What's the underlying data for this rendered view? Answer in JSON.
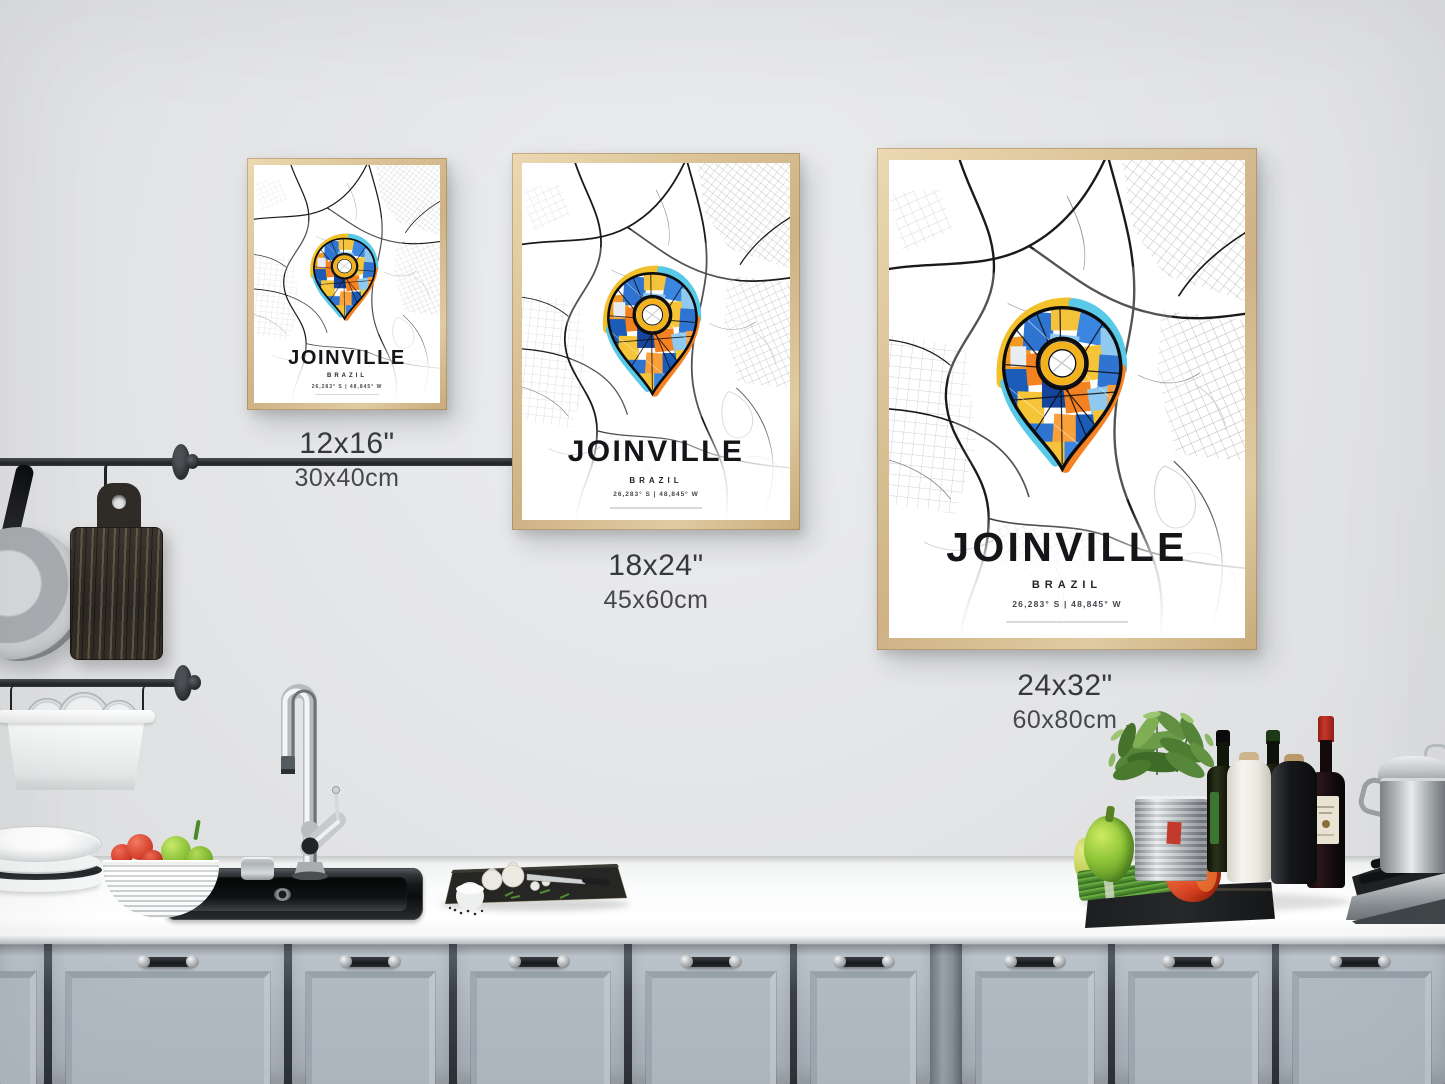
{
  "gallery": {
    "posters": [
      {
        "name": "small",
        "title": "JOINVILLE",
        "country": "BRAZIL",
        "coordinates": "26,283° S | 48,845° W",
        "label_size_in": "12x16\"",
        "label_size_cm": "30x40cm"
      },
      {
        "name": "medium",
        "title": "JOINVILLE",
        "country": "BRAZIL",
        "coordinates": "26,283° S | 48,845° W",
        "label_size_in": "18x24\"",
        "label_size_cm": "45x60cm"
      },
      {
        "name": "large",
        "title": "JOINVILLE",
        "country": "BRAZIL",
        "coordinates": "26,283° S | 48,845° W",
        "label_size_in": "24x32\"",
        "label_size_cm": "60x80cm"
      }
    ]
  },
  "palette": {
    "pin_orange": "#f58220",
    "pin_yellow": "#f2c028",
    "pin_cyan": "#59c9e8",
    "pin_blue": "#2f74d0",
    "pin_dark_blue": "#15459c",
    "pin_light_blue": "#8fc9ef",
    "frame_wood": "#d9c093",
    "cabinet_blue_gray": "#b2bbc3",
    "wall_gray": "#e4e5e7"
  }
}
